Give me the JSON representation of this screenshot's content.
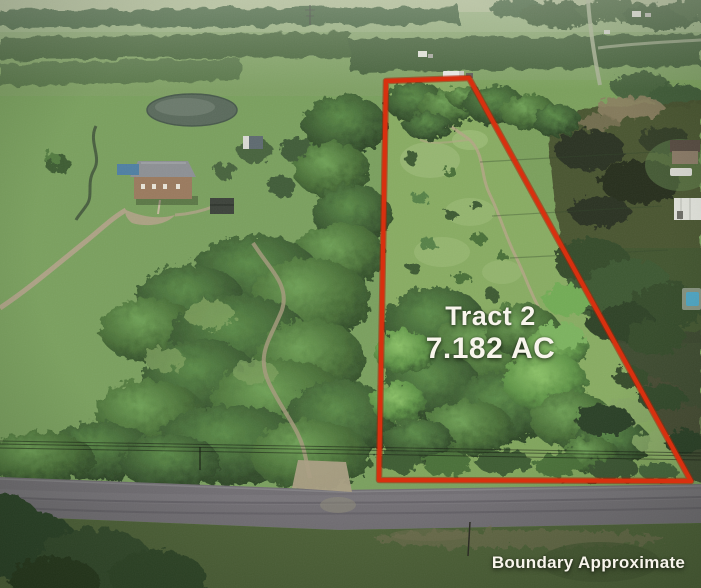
{
  "photo": {
    "kind": "aerial-drone-land-listing",
    "tract": {
      "name": "Tract 2",
      "acreage": "7.182 AC"
    },
    "disclaimer": "Boundary Approximate",
    "colors": {
      "boundary": "#d8300f",
      "label_text": "#f8f5ec"
    }
  }
}
